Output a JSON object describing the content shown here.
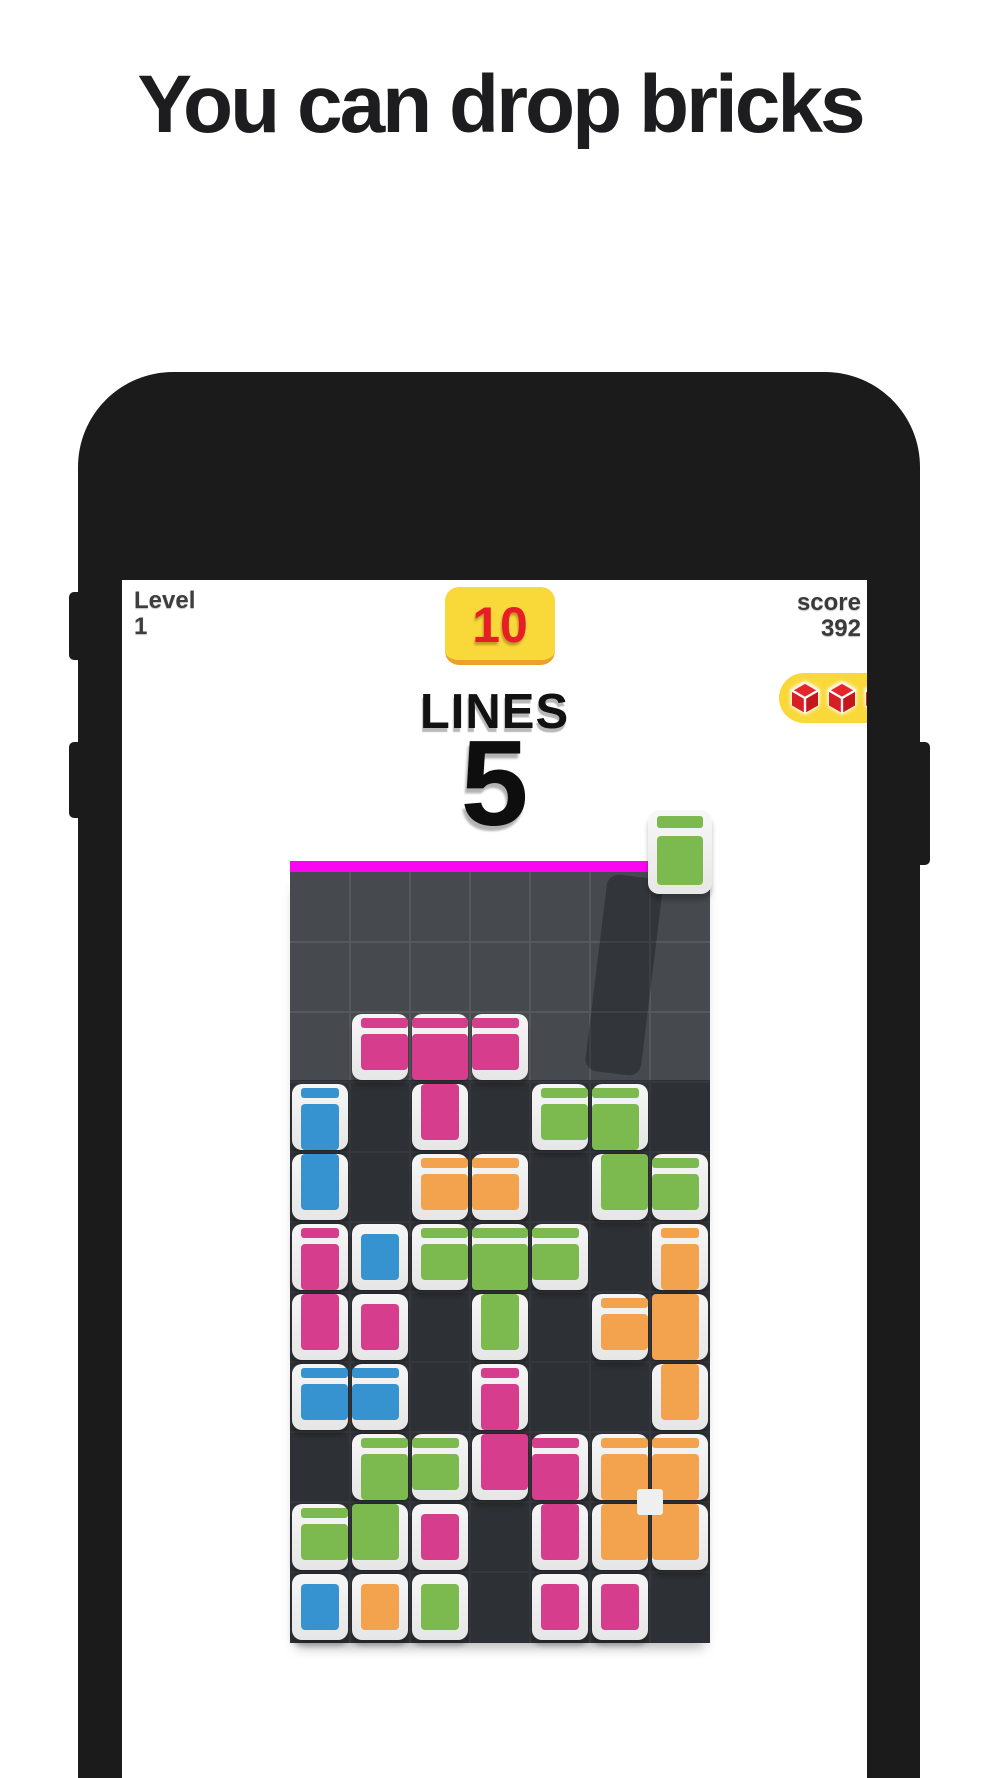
{
  "title": "You can drop bricks",
  "hud": {
    "level_label": "Level",
    "level_value": "1",
    "lines_goal_badge": "10",
    "lines_label": "LINES",
    "lines_value": "5",
    "score_label": "score",
    "score_value": "392",
    "booster_bricks_count": 3
  },
  "colors": {
    "pink": "#d63d8d",
    "blue": "#3793d0",
    "green": "#7cb94f",
    "orange": "#f3a24e",
    "yellow": "#f9d93a",
    "badge_edge": "#ef9f2b",
    "red": "#e81d25",
    "magenta": "#fb06f0",
    "board_bg": "#46494e",
    "grid_line": "#55585d",
    "cube_red_top": "#e5262b",
    "cube_red_left": "#d61e24",
    "cube_red_right": "#c5161c"
  },
  "board": {
    "cols": 7,
    "rows": 11,
    "ghost_shadow_column": 6,
    "pieces": [
      {
        "name": "pink-t-piece",
        "color": "pink",
        "cells": [
          [
            2,
            3
          ],
          [
            3,
            3
          ],
          [
            4,
            3
          ],
          [
            3,
            4
          ]
        ]
      },
      {
        "name": "blue-vertical-piece",
        "color": "blue",
        "cells": [
          [
            1,
            4
          ],
          [
            1,
            5
          ]
        ]
      },
      {
        "name": "green-s-piece-right",
        "color": "green",
        "cells": [
          [
            5,
            4
          ],
          [
            6,
            4
          ],
          [
            6,
            5
          ],
          [
            7,
            5
          ]
        ]
      },
      {
        "name": "orange-pair-piece",
        "color": "orange",
        "cells": [
          [
            3,
            5
          ],
          [
            4,
            5
          ]
        ]
      },
      {
        "name": "pink-vertical-piece",
        "color": "pink",
        "cells": [
          [
            1,
            6
          ],
          [
            1,
            7
          ]
        ]
      },
      {
        "name": "blue-single-brick",
        "color": "blue",
        "cells": [
          [
            2,
            6
          ]
        ]
      },
      {
        "name": "pink-single-brick",
        "color": "pink",
        "cells": [
          [
            2,
            7
          ]
        ]
      },
      {
        "name": "green-t-piece",
        "color": "green",
        "cells": [
          [
            3,
            6
          ],
          [
            4,
            6
          ],
          [
            5,
            6
          ],
          [
            4,
            7
          ]
        ]
      },
      {
        "name": "orange-t-piece",
        "color": "orange",
        "cells": [
          [
            7,
            6
          ],
          [
            6,
            7
          ],
          [
            7,
            7
          ],
          [
            7,
            8
          ]
        ]
      },
      {
        "name": "blue-pair-piece",
        "color": "blue",
        "cells": [
          [
            1,
            8
          ],
          [
            2,
            8
          ]
        ]
      },
      {
        "name": "pink-s-piece",
        "color": "pink",
        "cells": [
          [
            4,
            8
          ],
          [
            4,
            9
          ],
          [
            5,
            9
          ],
          [
            5,
            10
          ]
        ]
      },
      {
        "name": "green-s-piece-left",
        "color": "green",
        "cells": [
          [
            2,
            9
          ],
          [
            3,
            9
          ],
          [
            1,
            10
          ],
          [
            2,
            10
          ]
        ]
      },
      {
        "name": "pink-single-low",
        "color": "pink",
        "cells": [
          [
            3,
            10
          ]
        ]
      },
      {
        "name": "orange-square-piece",
        "color": "orange",
        "cells": [
          [
            6,
            9
          ],
          [
            7,
            9
          ],
          [
            6,
            10
          ],
          [
            7,
            10
          ]
        ],
        "hole": true
      },
      {
        "name": "blue-bottom-brick",
        "color": "blue",
        "cells": [
          [
            1,
            11
          ]
        ]
      },
      {
        "name": "orange-bottom-brick",
        "color": "orange",
        "cells": [
          [
            2,
            11
          ]
        ]
      },
      {
        "name": "green-bottom-brick",
        "color": "green",
        "cells": [
          [
            3,
            11
          ]
        ]
      },
      {
        "name": "pink-bottom-brick-1",
        "color": "pink",
        "cells": [
          [
            5,
            11
          ]
        ]
      },
      {
        "name": "pink-bottom-brick-2",
        "color": "pink",
        "cells": [
          [
            6,
            11
          ]
        ]
      }
    ],
    "falling_brick": {
      "color": "green",
      "column": 7
    }
  }
}
